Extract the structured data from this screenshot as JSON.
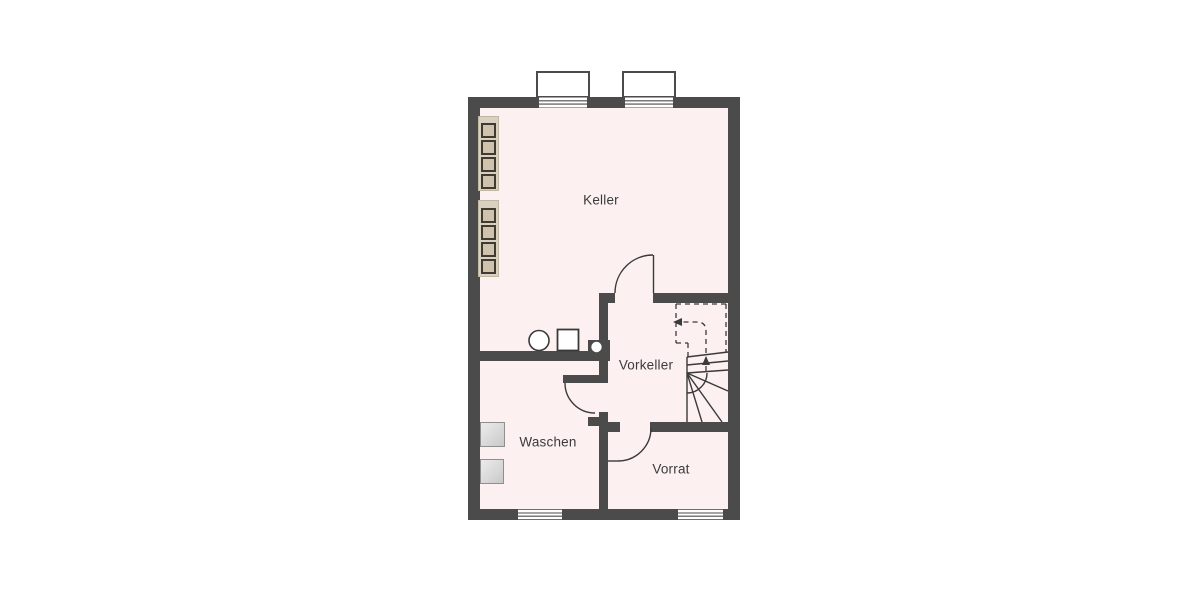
{
  "plan_title": "Kellergeschoss-Grundriss",
  "colors": {
    "background": "#ffffff",
    "wall": "#4b4b4b",
    "floor": "#fcf1f0",
    "line": "#3a3a3a",
    "text": "#3b3b3b",
    "shelf_fill": "#d9d0c1",
    "shelf_box_fill": "#cfc3ad",
    "shelf_box_border": "#403a30",
    "appliance_fill_light": "#ececec",
    "appliance_fill_dark": "#c9c9c9",
    "appliance_border": "#8f8f8f"
  },
  "rooms": [
    {
      "id": "keller",
      "label": "Keller"
    },
    {
      "id": "vorkeller",
      "label": "Vorkeller"
    },
    {
      "id": "waschen",
      "label": "Waschen"
    },
    {
      "id": "vorrat",
      "label": "Vorrat"
    }
  ],
  "features": {
    "windows_top": 2,
    "windows_bottom": 2,
    "door_swings": 3,
    "staircase": "winder-stairs, dashed upper flight with up walk-line arrows",
    "shelf_units": 2,
    "shelf_compartments_per_unit": 4,
    "appliance_boxes_waschen": 2,
    "keller_symbols": [
      "circle-fixture",
      "square-fixture"
    ],
    "wall_symbol": "pipe-circle-in-wall"
  }
}
